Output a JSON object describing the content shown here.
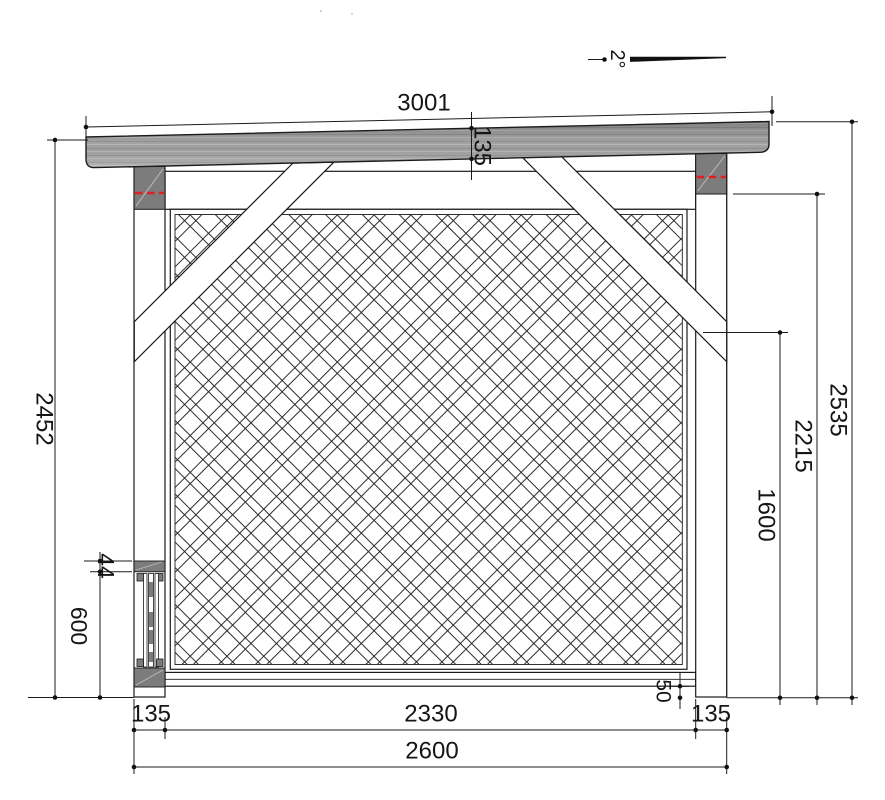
{
  "drawing": {
    "type": "technical-elevation",
    "angle_label": "2°",
    "dimensions": {
      "roof_length": "3001",
      "roof_beam_height": "135",
      "left_total_height": "2452",
      "right_total_height": "2535",
      "right_post_height": "2215",
      "right_brace_height": "1600",
      "anchor_plate_thickness": "44",
      "anchor_height": "600",
      "bottom_gap": "50",
      "left_post_width": "135",
      "clear_span": "2330",
      "right_post_width": "135",
      "total_width": "2600"
    },
    "colors": {
      "line": "#1b1b1b",
      "roof_gray": "#a6a6a6",
      "roof_streak_dark": "#8e8e8e",
      "roof_streak_light": "#bcbcbc",
      "block_gray": "#7c7c7c",
      "red": "#e02020",
      "background": "#ffffff"
    }
  }
}
